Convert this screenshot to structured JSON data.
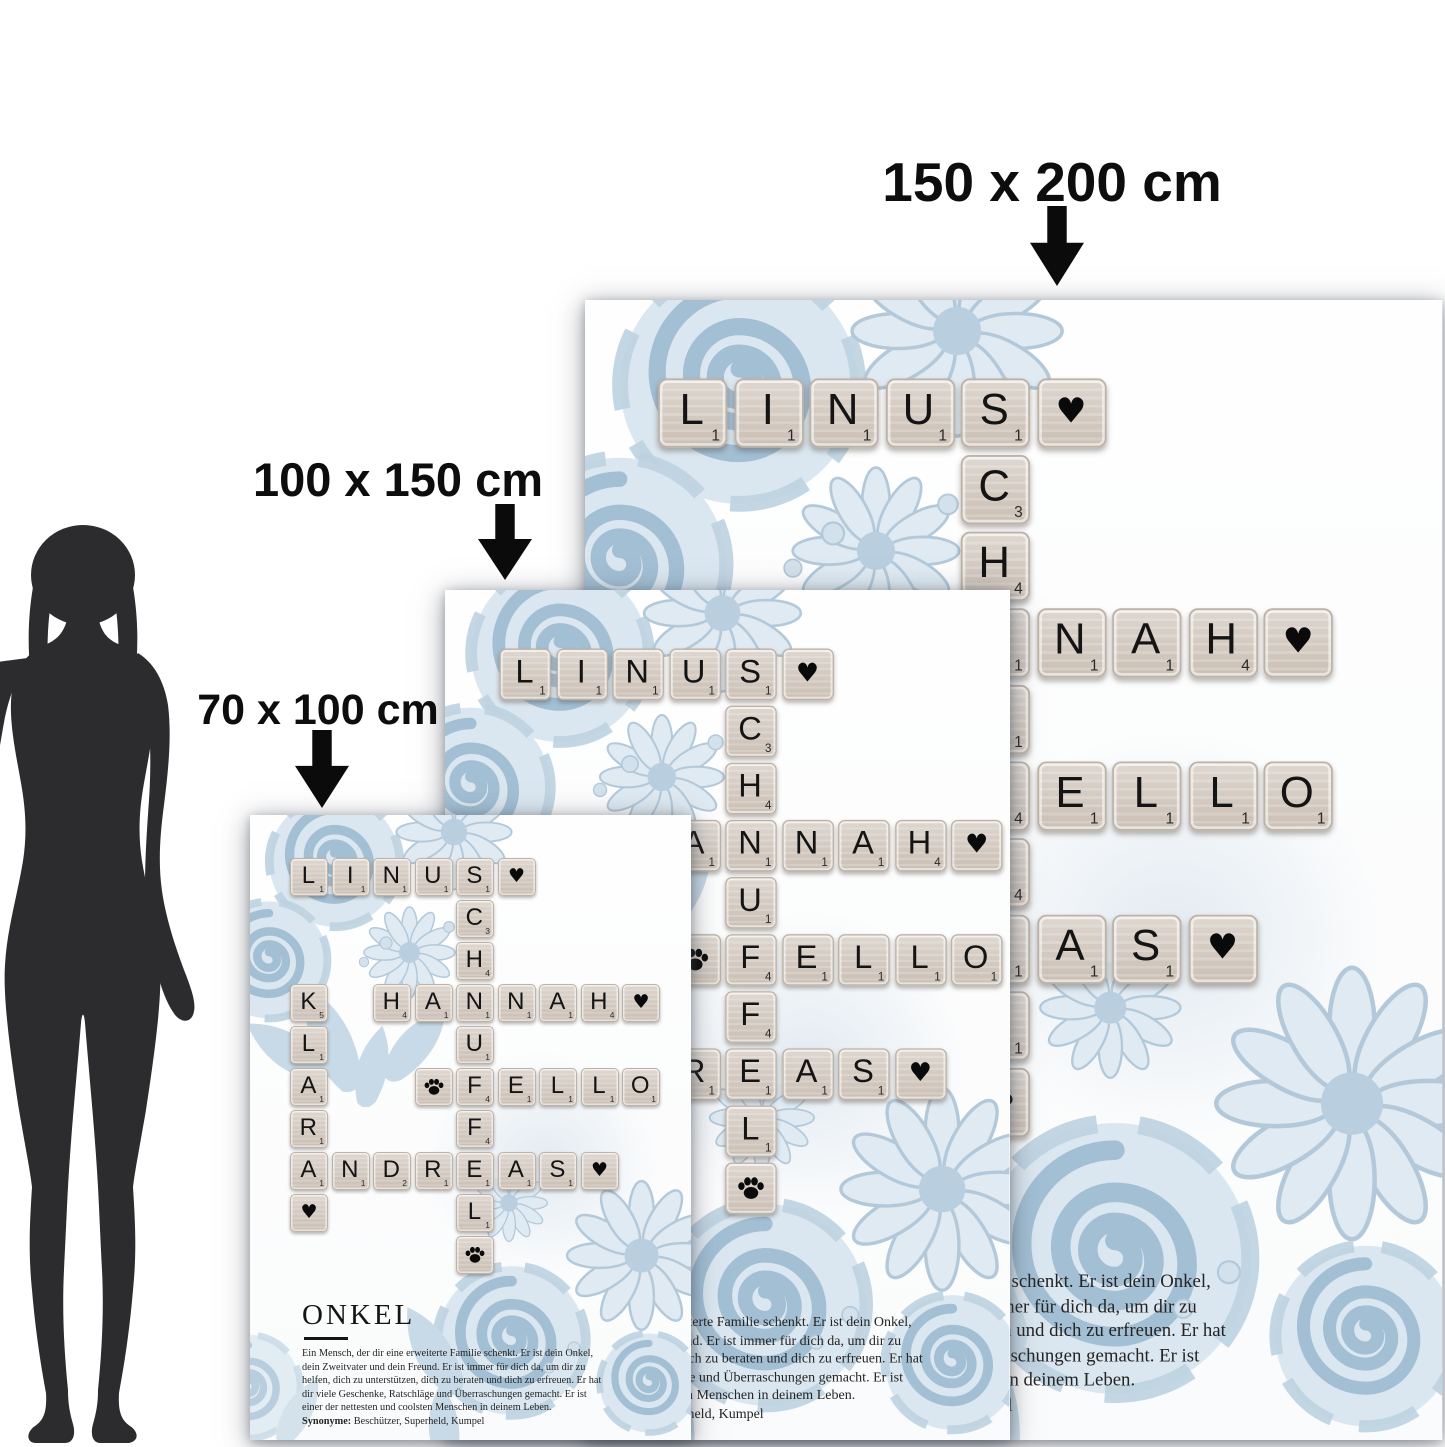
{
  "banner": {
    "title": "Größenvergleich",
    "bg_color": "#f4685e",
    "text_color": "#ffffff",
    "icon": "ruler-icon"
  },
  "size_labels": [
    {
      "text": "150 x 200 cm"
    },
    {
      "text": "100 x 150 cm"
    },
    {
      "text": "70 x 100 cm"
    }
  ],
  "poster": {
    "words": [
      "LINUS",
      "SCHNUFFEL",
      "HANNAH",
      "KLARA",
      "FELLO",
      "ANDREAS"
    ],
    "tiles": [
      {
        "r": 0,
        "c": 0,
        "t": "L",
        "v": 1
      },
      {
        "r": 0,
        "c": 1,
        "t": "I",
        "v": 1
      },
      {
        "r": 0,
        "c": 2,
        "t": "N",
        "v": 1
      },
      {
        "r": 0,
        "c": 3,
        "t": "U",
        "v": 1
      },
      {
        "r": 0,
        "c": 4,
        "t": "S",
        "v": 1
      },
      {
        "r": 0,
        "c": 5,
        "t": "heart"
      },
      {
        "r": 1,
        "c": 4,
        "t": "C",
        "v": 3
      },
      {
        "r": 2,
        "c": 4,
        "t": "H",
        "v": 4
      },
      {
        "r": 3,
        "c": 0,
        "t": "K",
        "v": 5
      },
      {
        "r": 3,
        "c": 2,
        "t": "H",
        "v": 4
      },
      {
        "r": 3,
        "c": 3,
        "t": "A",
        "v": 1
      },
      {
        "r": 3,
        "c": 4,
        "t": "N",
        "v": 1
      },
      {
        "r": 3,
        "c": 5,
        "t": "N",
        "v": 1
      },
      {
        "r": 3,
        "c": 6,
        "t": "A",
        "v": 1
      },
      {
        "r": 3,
        "c": 7,
        "t": "H",
        "v": 4
      },
      {
        "r": 3,
        "c": 8,
        "t": "heart"
      },
      {
        "r": 4,
        "c": 0,
        "t": "L",
        "v": 1
      },
      {
        "r": 4,
        "c": 4,
        "t": "U",
        "v": 1
      },
      {
        "r": 5,
        "c": 0,
        "t": "A",
        "v": 1
      },
      {
        "r": 5,
        "c": 3,
        "t": "paw"
      },
      {
        "r": 5,
        "c": 4,
        "t": "F",
        "v": 4
      },
      {
        "r": 5,
        "c": 5,
        "t": "E",
        "v": 1
      },
      {
        "r": 5,
        "c": 6,
        "t": "L",
        "v": 1
      },
      {
        "r": 5,
        "c": 7,
        "t": "L",
        "v": 1
      },
      {
        "r": 5,
        "c": 8,
        "t": "O",
        "v": 1
      },
      {
        "r": 6,
        "c": 0,
        "t": "R",
        "v": 1
      },
      {
        "r": 6,
        "c": 4,
        "t": "F",
        "v": 4
      },
      {
        "r": 7,
        "c": 0,
        "t": "A",
        "v": 1
      },
      {
        "r": 7,
        "c": 1,
        "t": "N",
        "v": 1
      },
      {
        "r": 7,
        "c": 2,
        "t": "D",
        "v": 2
      },
      {
        "r": 7,
        "c": 3,
        "t": "R",
        "v": 1
      },
      {
        "r": 7,
        "c": 4,
        "t": "E",
        "v": 1
      },
      {
        "r": 7,
        "c": 5,
        "t": "A",
        "v": 1
      },
      {
        "r": 7,
        "c": 6,
        "t": "S",
        "v": 1
      },
      {
        "r": 7,
        "c": 7,
        "t": "heart"
      },
      {
        "r": 8,
        "c": 0,
        "t": "heart"
      },
      {
        "r": 8,
        "c": 4,
        "t": "L",
        "v": 1
      },
      {
        "r": 9,
        "c": 4,
        "t": "paw"
      }
    ],
    "heading": "ONKEL",
    "definition_lines": [
      "Ein Mensch, der dir eine erweiterte Familie schenkt. Er ist dein Onkel,",
      "dein Zweitvater und dein Freund. Er ist immer für dich da, um dir zu",
      "helfen, dich zu unterstützen, dich zu beraten und dich zu erfreuen. Er hat",
      "dir viele Geschenke, Ratschläge und Überraschungen gemacht. Er ist",
      "einer der nettesten und coolsten Menschen in deinem Leben."
    ],
    "synonyms_label": "Synonyme:",
    "synonyms": "Beschützer, Superheld, Kumpel",
    "tile_color": "#d5ccc3",
    "flower_color": "#bdd2e2"
  },
  "figure": {
    "name": "person-silhouette",
    "color": "#2c2c2f"
  }
}
